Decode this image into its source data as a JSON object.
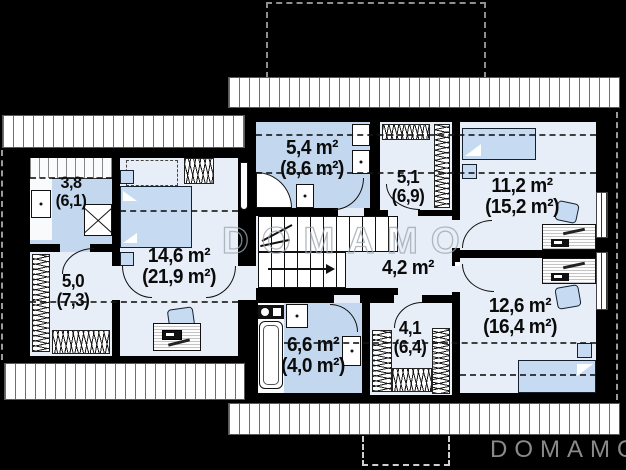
{
  "plan": {
    "title": "Attic floor plan",
    "watermark_text": "DOMAMO",
    "logo_text": "DOMAMO",
    "colors": {
      "background": "#000000",
      "room_floor": "#e8eef7",
      "bathroom_floor": "#c3d8ee",
      "furniture_blue": "#c6dbf2",
      "logo_gray": "#8a8a8a"
    },
    "rooms": [
      {
        "name": "bathroom-top-left",
        "area": "3,8",
        "full_area": "(6,1)"
      },
      {
        "name": "wardrobe-left",
        "area": "5,0",
        "full_area": "(7,3)"
      },
      {
        "name": "bedroom-left",
        "area": "14,6 m²",
        "full_area": "(21,9 m²)"
      },
      {
        "name": "bathroom-top-center",
        "area": "5,4 m²",
        "full_area": "(8,6 m²)"
      },
      {
        "name": "wardrobe-top-center",
        "area": "5,1",
        "full_area": "(6,9)"
      },
      {
        "name": "bedroom-top-right",
        "area": "11,2 m²",
        "full_area": "(15,2 m²)"
      },
      {
        "name": "hallway-center",
        "area": "4,2 m²",
        "full_area": ""
      },
      {
        "name": "bathroom-bottom-center",
        "area": "6,6 m²",
        "full_area": "(4,0 m²)"
      },
      {
        "name": "wardrobe-bottom-center",
        "area": "4,1",
        "full_area": "(6,4)"
      },
      {
        "name": "bedroom-bottom-right",
        "area": "12,6 m²",
        "full_area": "(16,4 m²)"
      }
    ]
  }
}
